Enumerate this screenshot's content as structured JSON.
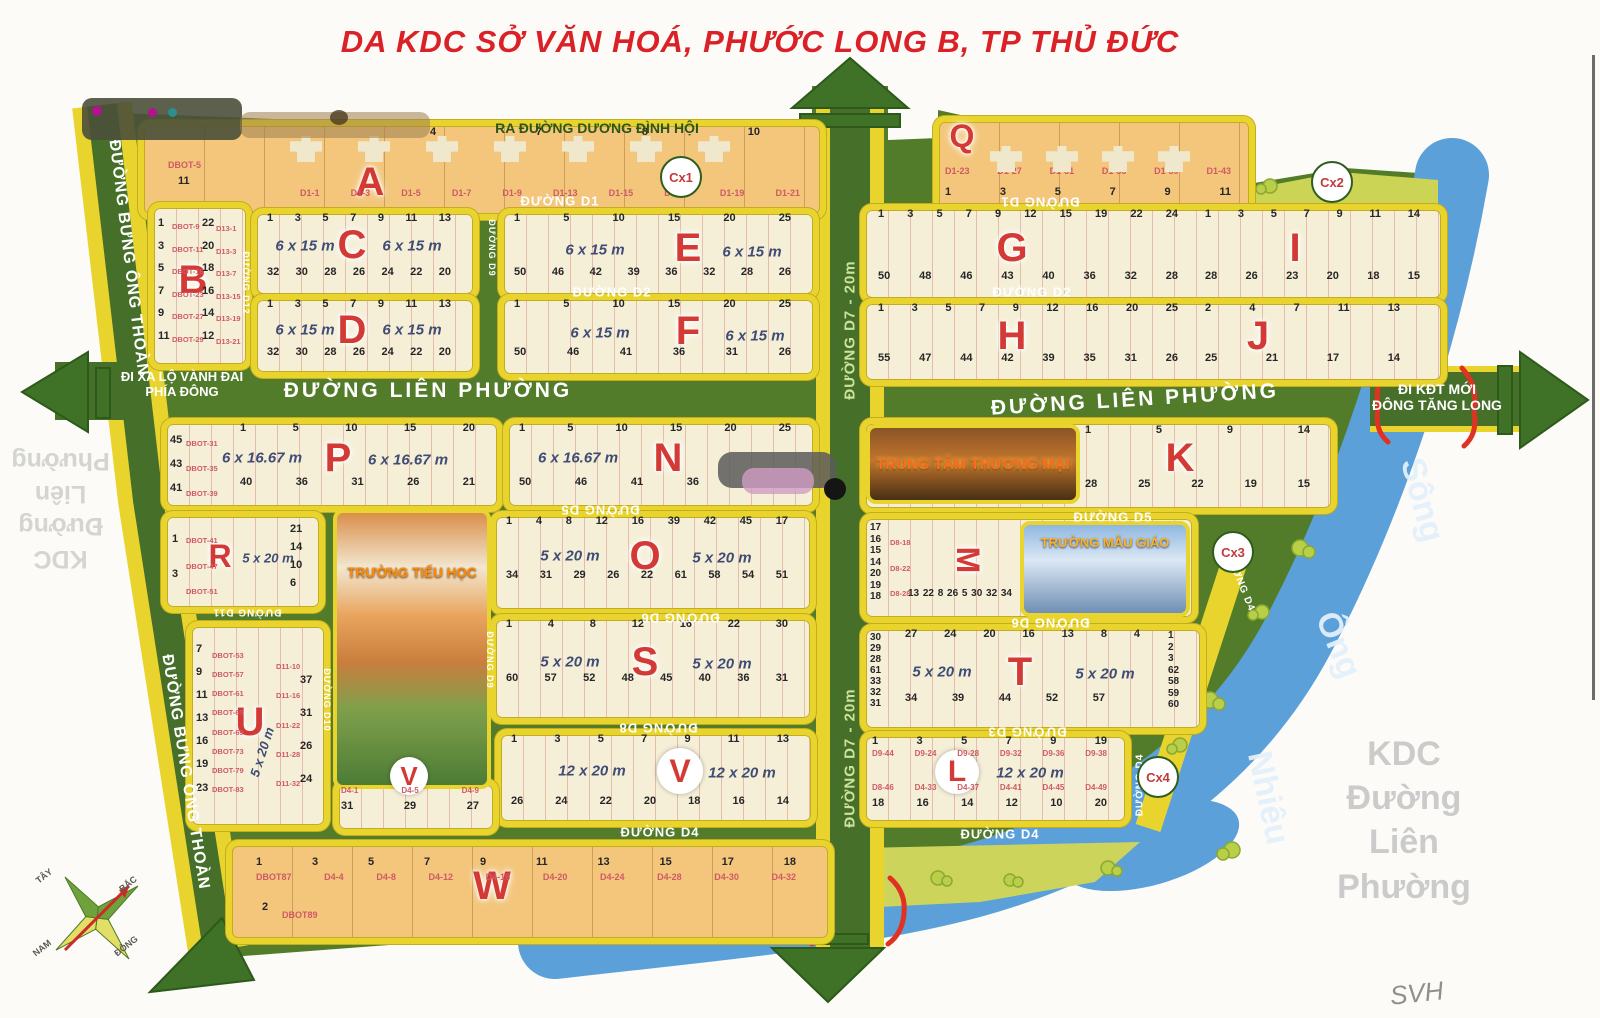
{
  "title": "DA KDC SỞ VĂN HOÁ, PHƯỚC LONG B, TP THỦ ĐỨC",
  "signature": "SVH",
  "exits": {
    "north": "RA ĐƯỜNG DƯƠNG ĐÌNH HỘI",
    "west_line1": "ĐI XA LỘ VÀNH ĐAI",
    "west_line2": "PHÍA ĐÔNG",
    "east_line1": "ĐI KĐT MỚI",
    "east_line2": "ĐÔNG TĂNG LONG"
  },
  "roads": {
    "lien_phuong": "ĐƯỜNG LIÊN PHƯỜNG",
    "bung_ong_thoan": "ĐƯỜNG BƯNG ÔNG THOÀN",
    "d1": "ĐƯỜNG D1",
    "d2": "ĐƯỜNG D2",
    "d3": "ĐƯỜNG D3",
    "d4": "ĐƯỜNG D4",
    "d5": "ĐƯỜNG D5",
    "d6": "ĐƯỜNG D6",
    "d7": "ĐƯỜNG D7 - 20m",
    "d8": "ĐƯỜNG D8",
    "d9": "ĐƯỜNG D9",
    "d10": "ĐƯỜNG D10",
    "d11": "ĐƯỜNG D11",
    "d12": "ĐƯỜNG D12"
  },
  "river": {
    "word1": "Sông",
    "word2": "Ông",
    "word3": "Nhiêu"
  },
  "watermark": {
    "line1": "KDC",
    "line2": "Đường",
    "line3": "Liên",
    "line4": "Phường"
  },
  "compass": {
    "north": "BẮC",
    "south": "NAM",
    "east": "ĐÔNG",
    "west": "TÂY"
  },
  "green_areas": {
    "cx1": "Cx1",
    "cx2": "Cx2",
    "cx3": "Cx3",
    "cx4": "Cx4"
  },
  "landmarks": {
    "school": "TRƯỜNG TIỂU HỌC",
    "mall": "TRUNG TÂM THƯƠNG MẠI",
    "kindergarten": "TRƯỜNG MẪU GIÁO"
  },
  "blocks": {
    "A": {
      "letter": "A",
      "note_lot": "DBOT-5",
      "note_num": "11",
      "numbers": [
        "4",
        "7",
        "8",
        "10"
      ],
      "lots": [
        "D1-1",
        "D1-3",
        "D1-5",
        "D1-7",
        "D1-9",
        "D1-13",
        "D1-15",
        "D1-17",
        "D1-19",
        "D1-21"
      ]
    },
    "Q": {
      "letter": "Q",
      "numbers": [
        "1",
        "3",
        "5",
        "7",
        "9",
        "11"
      ],
      "lots": [
        "D1-23",
        "D1-27",
        "D1-31",
        "D1-35",
        "D1-39",
        "D1-43"
      ]
    },
    "B": {
      "letter": "B",
      "col1": [
        "1",
        "3",
        "5",
        "7",
        "9",
        "11"
      ],
      "col2": [
        "DBOT-9",
        "DBOT-11",
        "DBOT-19",
        "DBOT-23",
        "DBOT-27",
        "DBOT-29"
      ],
      "col3": [
        "22",
        "20",
        "18",
        "16",
        "14",
        "12"
      ],
      "col4": [
        "D13-1",
        "D13-3",
        "D13-7",
        "D13-15",
        "D13-19",
        "D13-21"
      ]
    },
    "C": {
      "letter": "C",
      "dim": "6 x 15 m",
      "top": [
        "1",
        "3",
        "5",
        "7",
        "9",
        "11",
        "13"
      ],
      "bottom": [
        "32",
        "30",
        "28",
        "26",
        "24",
        "22",
        "20"
      ]
    },
    "D": {
      "letter": "D",
      "dim": "6 x 15 m",
      "top": [
        "1",
        "3",
        "5",
        "7",
        "9",
        "11",
        "13"
      ],
      "bottom": [
        "32",
        "30",
        "28",
        "26",
        "24",
        "22",
        "20"
      ]
    },
    "E": {
      "letter": "E",
      "dim": "6 x 15 m",
      "top": [
        "1",
        "5",
        "10",
        "15",
        "20",
        "25"
      ],
      "bottom": [
        "50",
        "46",
        "42",
        "39",
        "36",
        "32",
        "28",
        "26"
      ]
    },
    "F": {
      "letter": "F",
      "dim": "6 x 15 m",
      "top": [
        "1",
        "5",
        "10",
        "15",
        "20",
        "25"
      ],
      "bottom": [
        "50",
        "46",
        "41",
        "36",
        "31",
        "26"
      ]
    },
    "G": {
      "letter": "G",
      "top": [
        "1",
        "3",
        "5",
        "7",
        "9",
        "12",
        "15",
        "19",
        "22",
        "24"
      ],
      "bottom": [
        "50",
        "48",
        "46",
        "43",
        "40",
        "36",
        "32",
        "28"
      ]
    },
    "I": {
      "letter": "I",
      "top": [
        "1",
        "3",
        "5",
        "7",
        "9",
        "11",
        "14"
      ],
      "bottom": [
        "28",
        "26",
        "23",
        "20",
        "18",
        "15"
      ]
    },
    "H": {
      "letter": "H",
      "top": [
        "1",
        "3",
        "5",
        "7",
        "9",
        "12",
        "16",
        "20",
        "25"
      ],
      "bottom": [
        "55",
        "47",
        "44",
        "42",
        "39",
        "35",
        "31",
        "26"
      ]
    },
    "J": {
      "letter": "J",
      "top": [
        "2",
        "4",
        "7",
        "11",
        "13"
      ],
      "bottom": [
        "25",
        "21",
        "17",
        "14"
      ]
    },
    "P": {
      "letter": "P",
      "dim": "6 x 16.67 m",
      "left_nums": [
        "45",
        "43",
        "41"
      ],
      "left_lots": [
        "DBOT-31",
        "DBOT-35",
        "DBOT-39"
      ],
      "top": [
        "1",
        "5",
        "10",
        "15",
        "20"
      ],
      "bottom": [
        "40",
        "36",
        "31",
        "26",
        "21"
      ]
    },
    "N": {
      "letter": "N",
      "dim": "6 x 16.67 m",
      "top": [
        "1",
        "5",
        "10",
        "15",
        "20",
        "25"
      ],
      "bottom": [
        "50",
        "46",
        "41",
        "36"
      ]
    },
    "K": {
      "letter": "K",
      "top": [
        "1",
        "5",
        "9",
        "14"
      ],
      "bottom": [
        "28",
        "25",
        "22",
        "19",
        "15"
      ]
    },
    "R": {
      "letter": "R",
      "dim": "5 x 20 m",
      "left_nums": [
        "1",
        "3"
      ],
      "left_lots": [
        "DBOT-41",
        "DBOT-47",
        "DBOT-51"
      ],
      "right_nums": [
        "21",
        "14",
        "10",
        "6"
      ]
    },
    "O": {
      "letter": "O",
      "dim": "5 x 20 m",
      "top": [
        "1",
        "4",
        "8",
        "12",
        "16",
        "39",
        "42",
        "45",
        "17"
      ],
      "bottom": [
        "34",
        "31",
        "29",
        "26",
        "22",
        "61",
        "58",
        "54",
        "51"
      ]
    },
    "M": {
      "letter": "M",
      "left_nums": [
        "17",
        "16",
        "15",
        "14",
        "20",
        "19",
        "18"
      ],
      "left_lots": [
        "D8-18",
        "D8-22",
        "D8-28"
      ],
      "mid_nums": [
        "13",
        "22",
        "8",
        "26",
        "5",
        "30",
        "32",
        "34"
      ]
    },
    "S": {
      "letter": "S",
      "dim": "5 x 20 m",
      "top": [
        "1",
        "4",
        "8",
        "12",
        "16",
        "22",
        "30"
      ],
      "bottom": [
        "60",
        "57",
        "52",
        "48",
        "45",
        "40",
        "36",
        "31"
      ]
    },
    "T": {
      "letter": "T",
      "dim": "5 x 20 m",
      "left_nums": [
        "30",
        "29",
        "28",
        "61",
        "33",
        "32",
        "31"
      ],
      "right_nums": [
        "1",
        "2",
        "3",
        "62",
        "58",
        "59",
        "60"
      ],
      "top": [
        "27",
        "24",
        "20",
        "16",
        "13",
        "8",
        "4"
      ],
      "bottom": [
        "34",
        "39",
        "44",
        "52",
        "57"
      ]
    },
    "U": {
      "letter": "U",
      "dim": "5 x 20 m",
      "left_nums": [
        "7",
        "9",
        "11",
        "13",
        "16",
        "19",
        "23"
      ],
      "left_lots": [
        "DBOT-53",
        "DBOT-57",
        "DBOT-61",
        "DBOT-65",
        "DBOT-69",
        "DBOT-73",
        "DBOT-79",
        "DBOT-83"
      ],
      "right_lots": [
        "D11-10",
        "D11-16",
        "D11-22",
        "D11-28",
        "D11-32"
      ],
      "right_nums": [
        "37",
        "31",
        "26",
        "24"
      ]
    },
    "V": {
      "letter": "V",
      "dim": "12 x 20 m",
      "top": [
        "1",
        "3",
        "5",
        "7",
        "9",
        "11",
        "13"
      ],
      "bottom": [
        "26",
        "24",
        "22",
        "20",
        "18",
        "16",
        "14"
      ]
    },
    "Vleft": {
      "nums": [
        "31",
        "29",
        "27"
      ],
      "lots": [
        "D4-1",
        "D4-5",
        "D4-9"
      ]
    },
    "L": {
      "letter": "L",
      "dim": "12 x 20 m",
      "top": [
        "1",
        "3",
        "5",
        "7",
        "9",
        "19"
      ],
      "top_lots": [
        "D9-44",
        "D9-24",
        "D9-28",
        "D9-32",
        "D9-36",
        "D9-38"
      ],
      "bottom": [
        "18",
        "16",
        "14",
        "12",
        "10",
        "20"
      ],
      "bottom_lots": [
        "D8-46",
        "D4-33",
        "D4-37",
        "D4-41",
        "D4-45",
        "D4-49"
      ]
    },
    "W": {
      "letter": "W",
      "top": [
        "1",
        "3",
        "5",
        "7",
        "9",
        "11",
        "13",
        "15",
        "17",
        "18"
      ],
      "lots": [
        "DBOT87",
        "D4-4",
        "D4-8",
        "D4-12",
        "D4-16",
        "D4-20",
        "D4-24",
        "D4-28",
        "D4-30",
        "D4-32"
      ],
      "second_num": "2",
      "second_lot": "DBOT89"
    }
  }
}
